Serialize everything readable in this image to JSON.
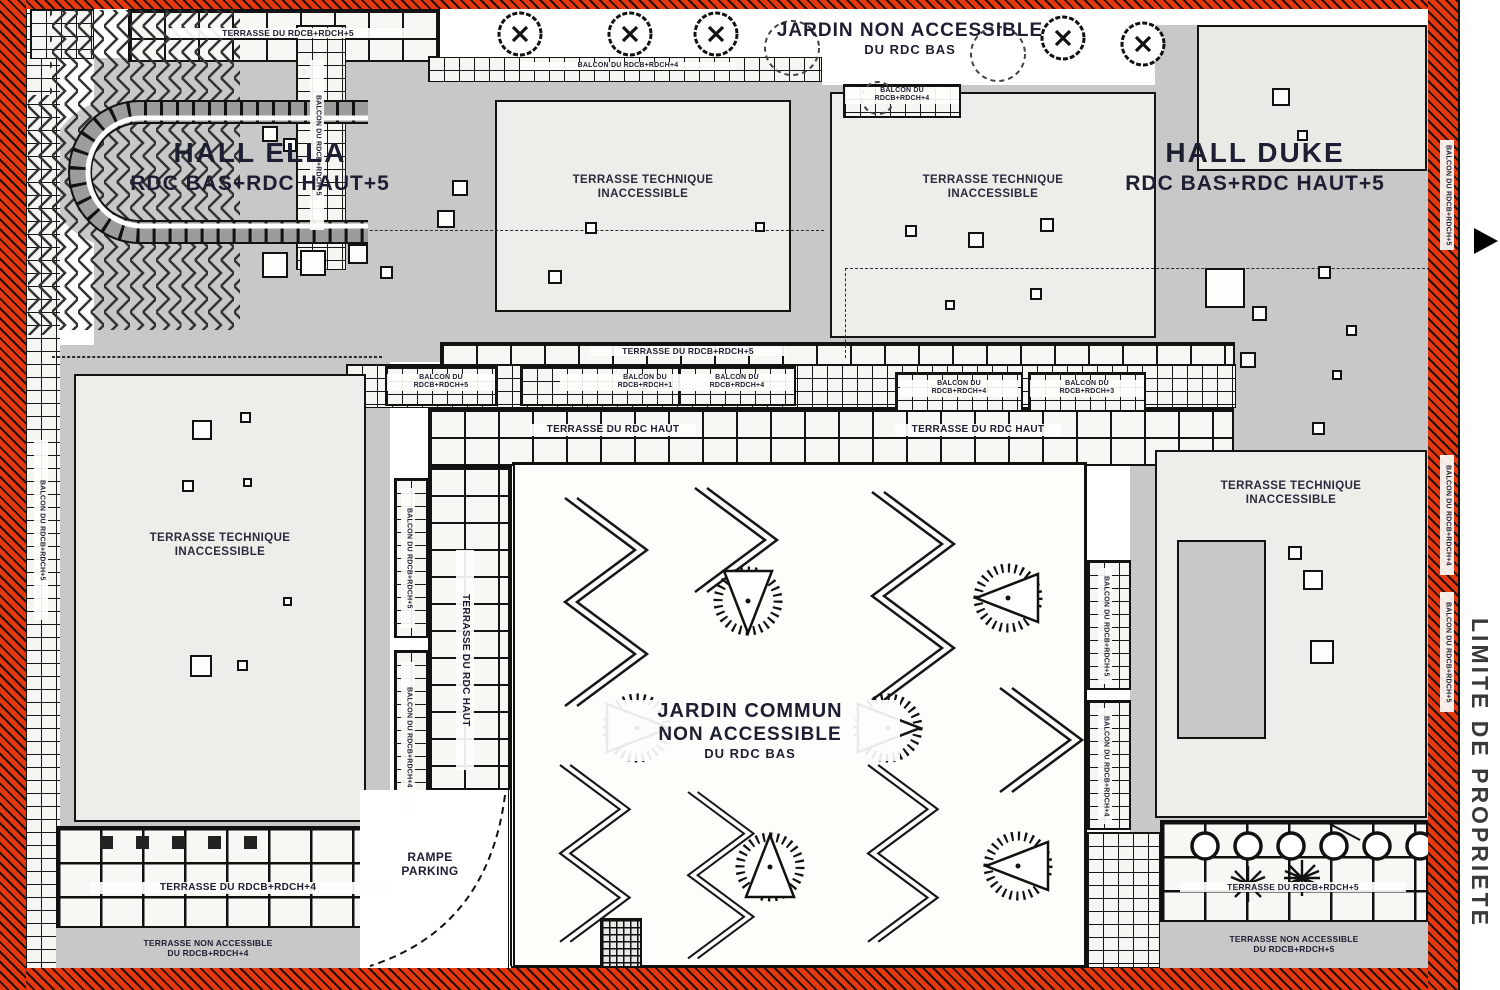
{
  "plan": {
    "halls": {
      "ella": {
        "name": "HALL ELLA",
        "levels": "RDC BAS+RDC HAUT+5"
      },
      "duke": {
        "name": "HALL DUKE",
        "levels": "RDC BAS+RDC HAUT+5"
      }
    },
    "gardens": {
      "top": {
        "line1": "JARDIN NON ACCESSIBLE",
        "line2": "DU RDC BAS"
      },
      "central": {
        "line1": "JARDIN COMMUN",
        "line2": "NON ACCESSIBLE",
        "line3": "DU RDC BAS"
      }
    },
    "technical_terrace": {
      "line1": "TERRASSE TECHNIQUE",
      "line2": "INACCESSIBLE"
    },
    "ramp": {
      "line1": "RAMPE",
      "line2": "PARKING"
    },
    "property_line": "LIMITE DE PROPRIETE",
    "terraces": {
      "rdcb_rdch5": "TERRASSE DU RDCB+RDCH+5",
      "rdcb_rdch4": "TERRASSE DU RDCB+RDCH+4",
      "rdc_haut": "TERRASSE DU RDC HAUT",
      "na_line1": "TERRASSE NON ACCESSIBLE",
      "na4_line2": "DU RDCB+RDCH+4",
      "na5_line2": "DU RDCB+RDCH+5"
    },
    "balconies": {
      "b5": {
        "l1": "BALCON DU",
        "l2": "RDCB+RDCH+5",
        "inline": "BALCON DU RDCB+RDCH+5"
      },
      "b4": {
        "l1": "BALCON DU",
        "l2": "RDCB+RDCH+4",
        "inline": "BALCON DU RDCB+RDCH+4"
      },
      "b1": {
        "l1": "BALCON DU",
        "l2": "RDCB+RDCH+1",
        "inline": "BALCON DU RDCB+RDCH+1"
      },
      "b3": {
        "l1": "BALCON DU",
        "l2": "RDCB+RDCH+3",
        "inline": "BALCON DU RDCB+RDCH+3"
      }
    },
    "colors": {
      "property_red": "#e5380e",
      "building_gray": "#c8c8c8",
      "technical_gray": "#ededea",
      "line_black": "#111111",
      "text_dark": "#1e1e32"
    }
  }
}
